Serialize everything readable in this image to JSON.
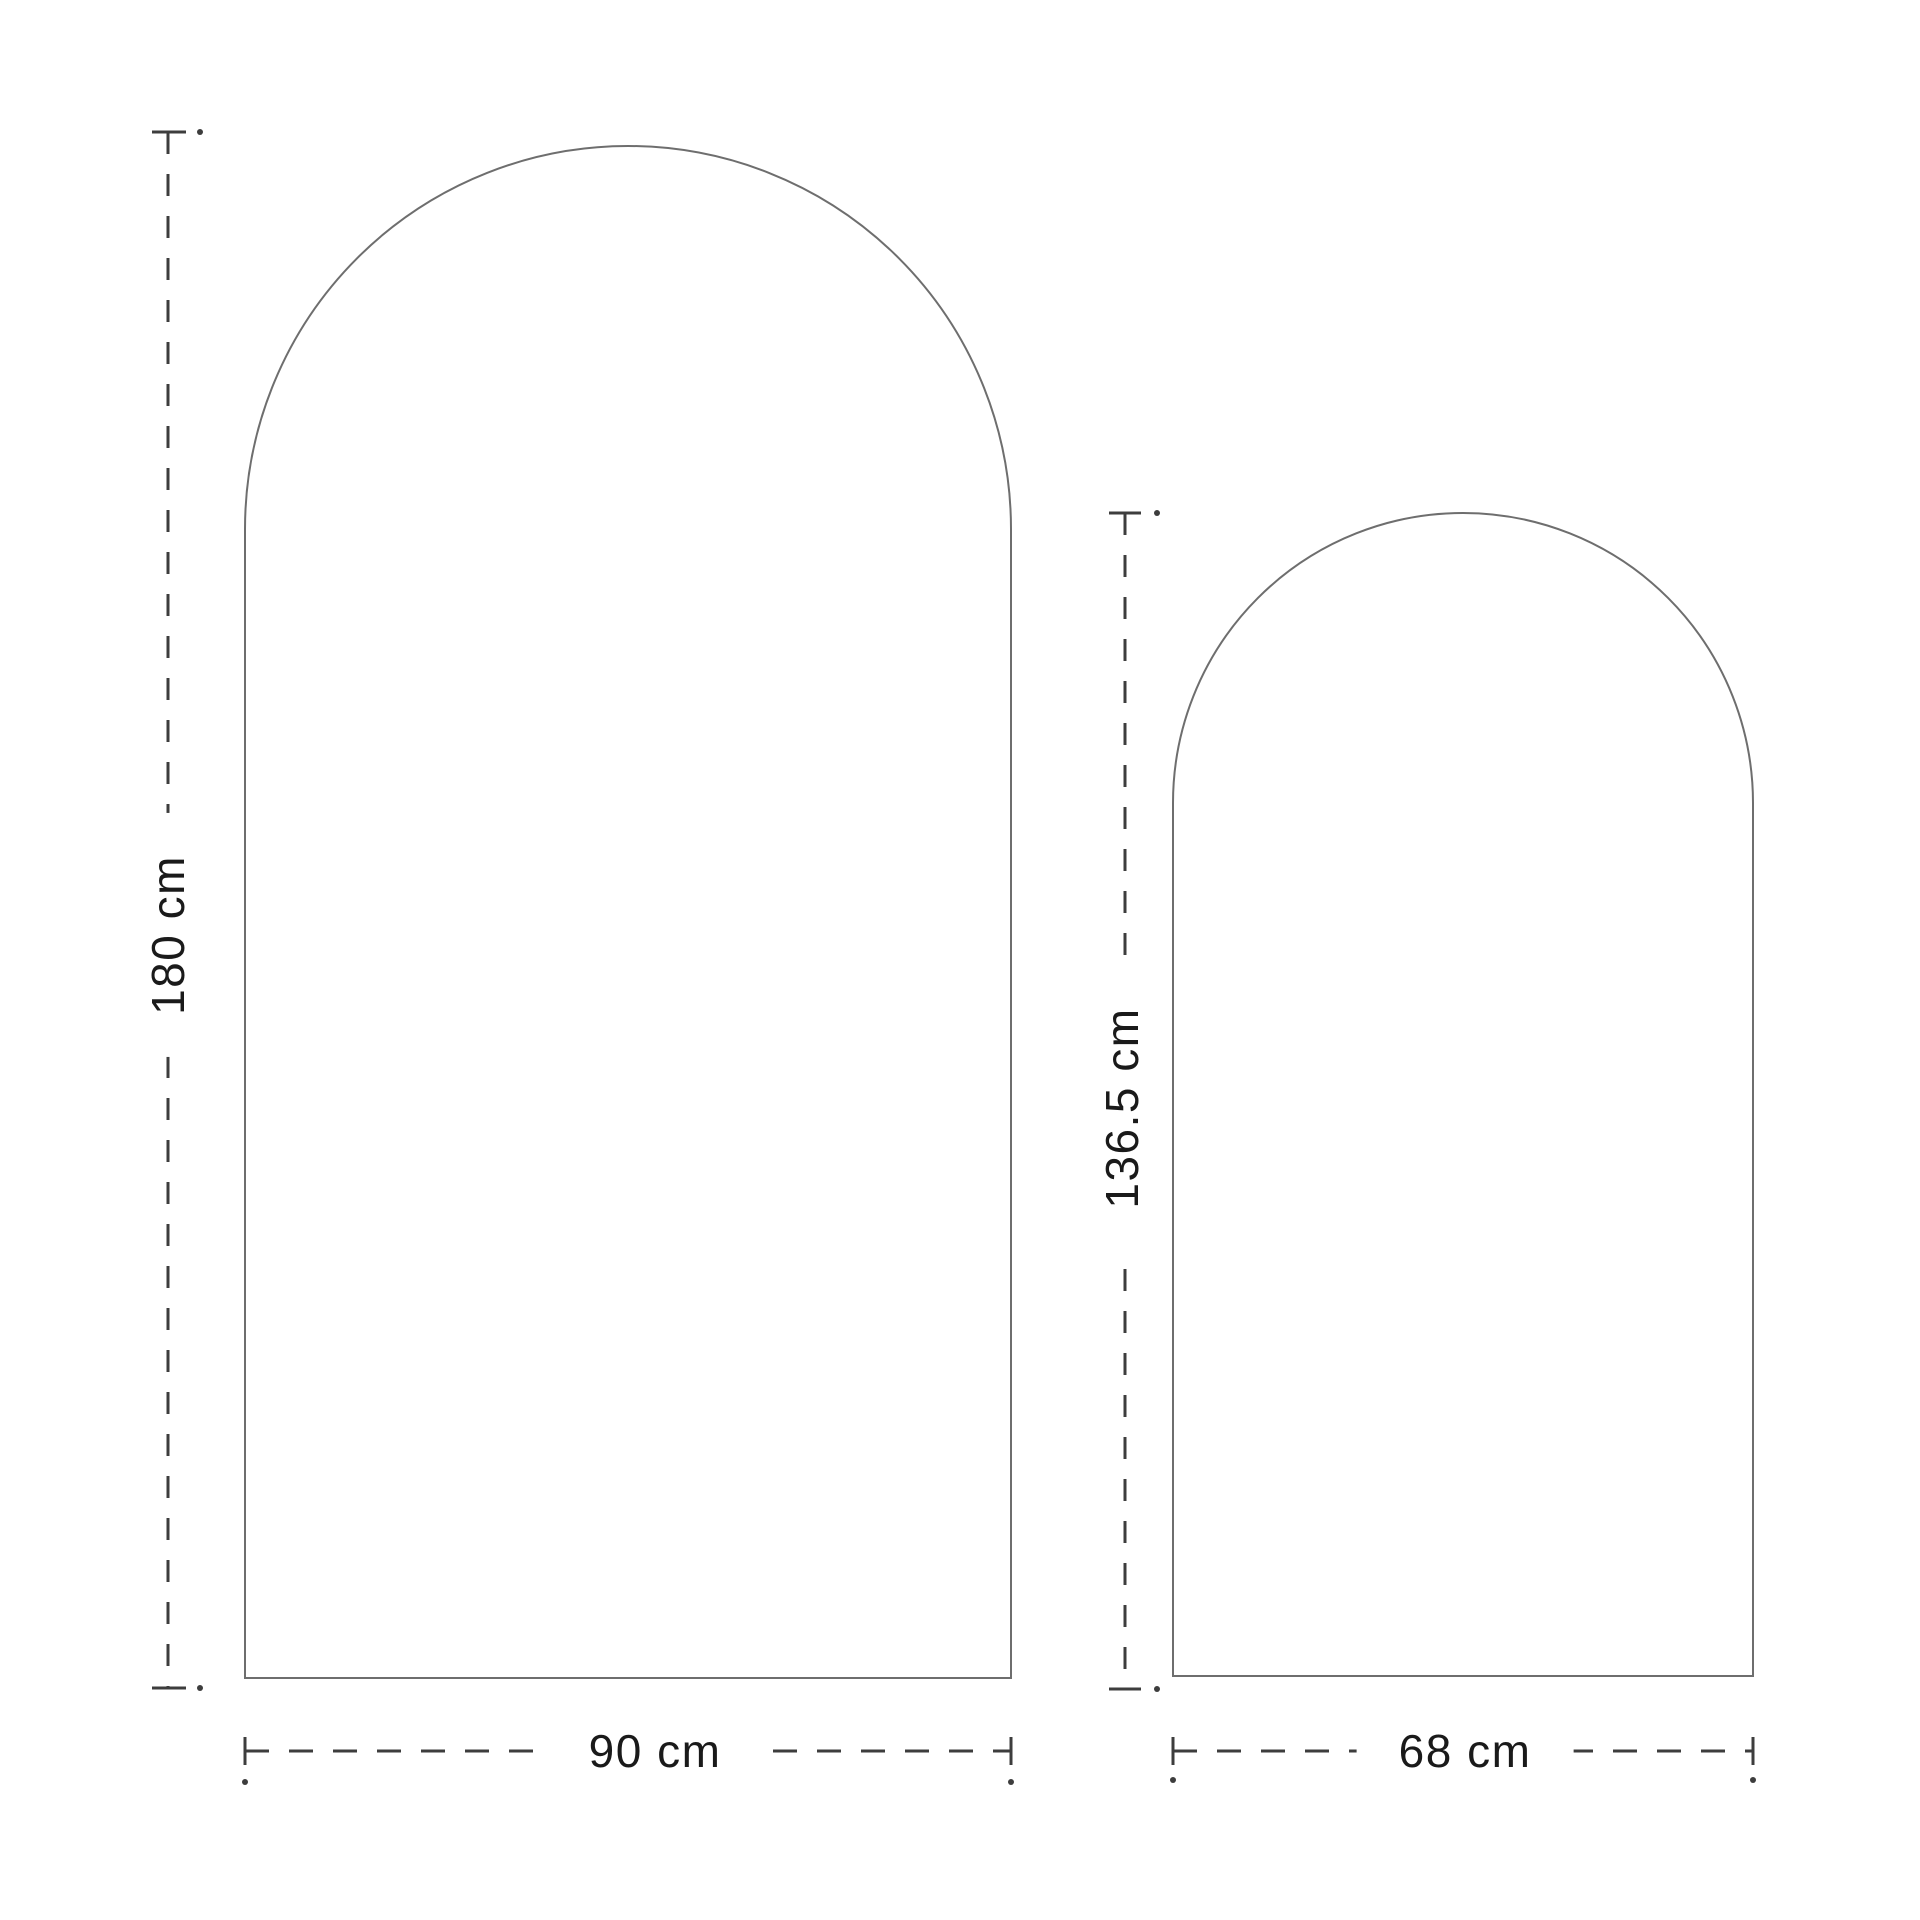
{
  "page": {
    "background_color": "#ffffff"
  },
  "diagram": {
    "type": "dimension-diagram",
    "arches": [
      {
        "id": "large-arch",
        "height_label": "180 cm",
        "width_label": "90 cm"
      },
      {
        "id": "small-arch",
        "height_label": "136.5 cm",
        "width_label": "68 cm"
      }
    ],
    "colors": {
      "shape_outline": "#6e6e6e",
      "dimension_line": "#3d3d3d",
      "label_text": "#1a1a1a"
    }
  }
}
